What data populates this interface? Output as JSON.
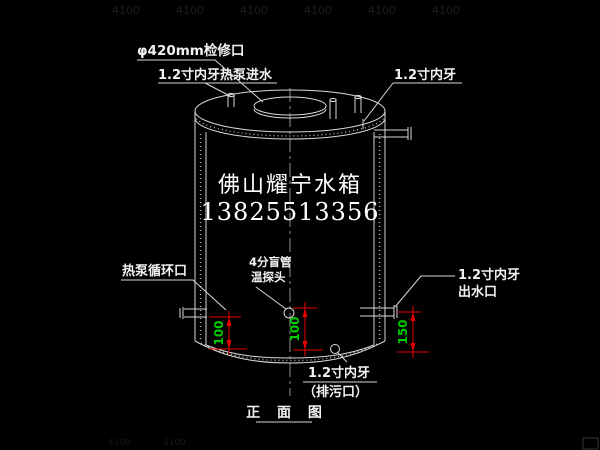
{
  "title": "正 面 图",
  "brand": {
    "name": "佛山耀宁水箱",
    "phone": "13825513356"
  },
  "labels": {
    "manhole": "φ420mm检修口",
    "hp_inlet": "1.2寸内牙热泵进水",
    "top_right_thread": "1.2寸内牙",
    "hp_circulation": "热泵循环口",
    "probe_line1": "4分盲管",
    "probe_line2": "温探头",
    "outlet_line1": "1.2寸内牙",
    "outlet_line2": "出水口",
    "drain_line1": "1.2寸内牙",
    "drain_line2": "（排污口）"
  },
  "dimensions": {
    "left_offset": "100",
    "center_offset": "100",
    "right_offset": "150"
  },
  "watermark": {
    "text": "4100"
  },
  "colors": {
    "background": "#000000",
    "line": "#d9d9d9",
    "dimension_line": "#e80000",
    "dimension_text": "#00cc00",
    "label_text": "#f2f2f2",
    "centerline": "#8f8f8f",
    "watermark": "#1d1d1d"
  }
}
